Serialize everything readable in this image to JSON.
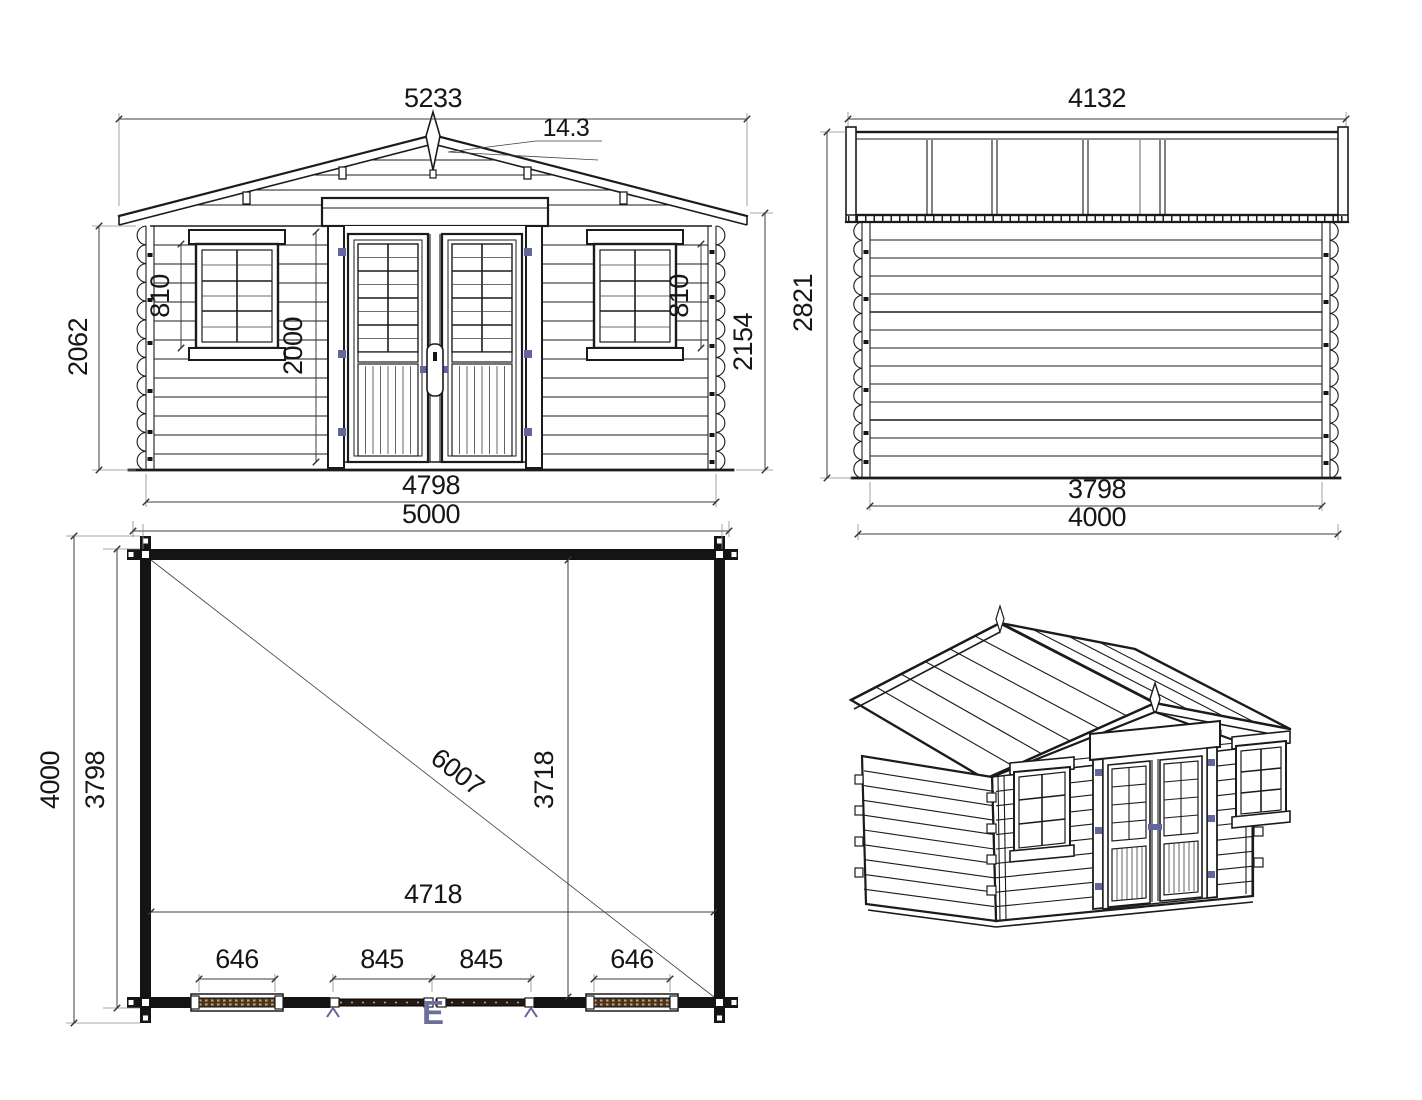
{
  "drawing": {
    "front": {
      "roof_width": "5233",
      "roof_angle": "14.3",
      "wall_height": "2062",
      "window_height_left": "810",
      "door_height": "2000",
      "window_height_right": "810",
      "total_height": "2154",
      "wall_width": "4798",
      "overall_width": "5000"
    },
    "side": {
      "roof_length": "4132",
      "total_height": "2821",
      "wall_length": "3798",
      "overall_length": "4000"
    },
    "plan": {
      "overall_depth": "4000",
      "wall_depth": "3798",
      "diagonal": "6007",
      "interior_depth": "3718",
      "interior_width": "4718",
      "window_left_width": "646",
      "door_left_width": "845",
      "door_right_width": "845",
      "window_right_width": "646",
      "entry_marker": "E"
    },
    "colors": {
      "line": "#1b1b1b",
      "dimension": "#3c3c3c",
      "accent_blue": "#62669e",
      "hatch_brown": "#4a3524"
    }
  }
}
